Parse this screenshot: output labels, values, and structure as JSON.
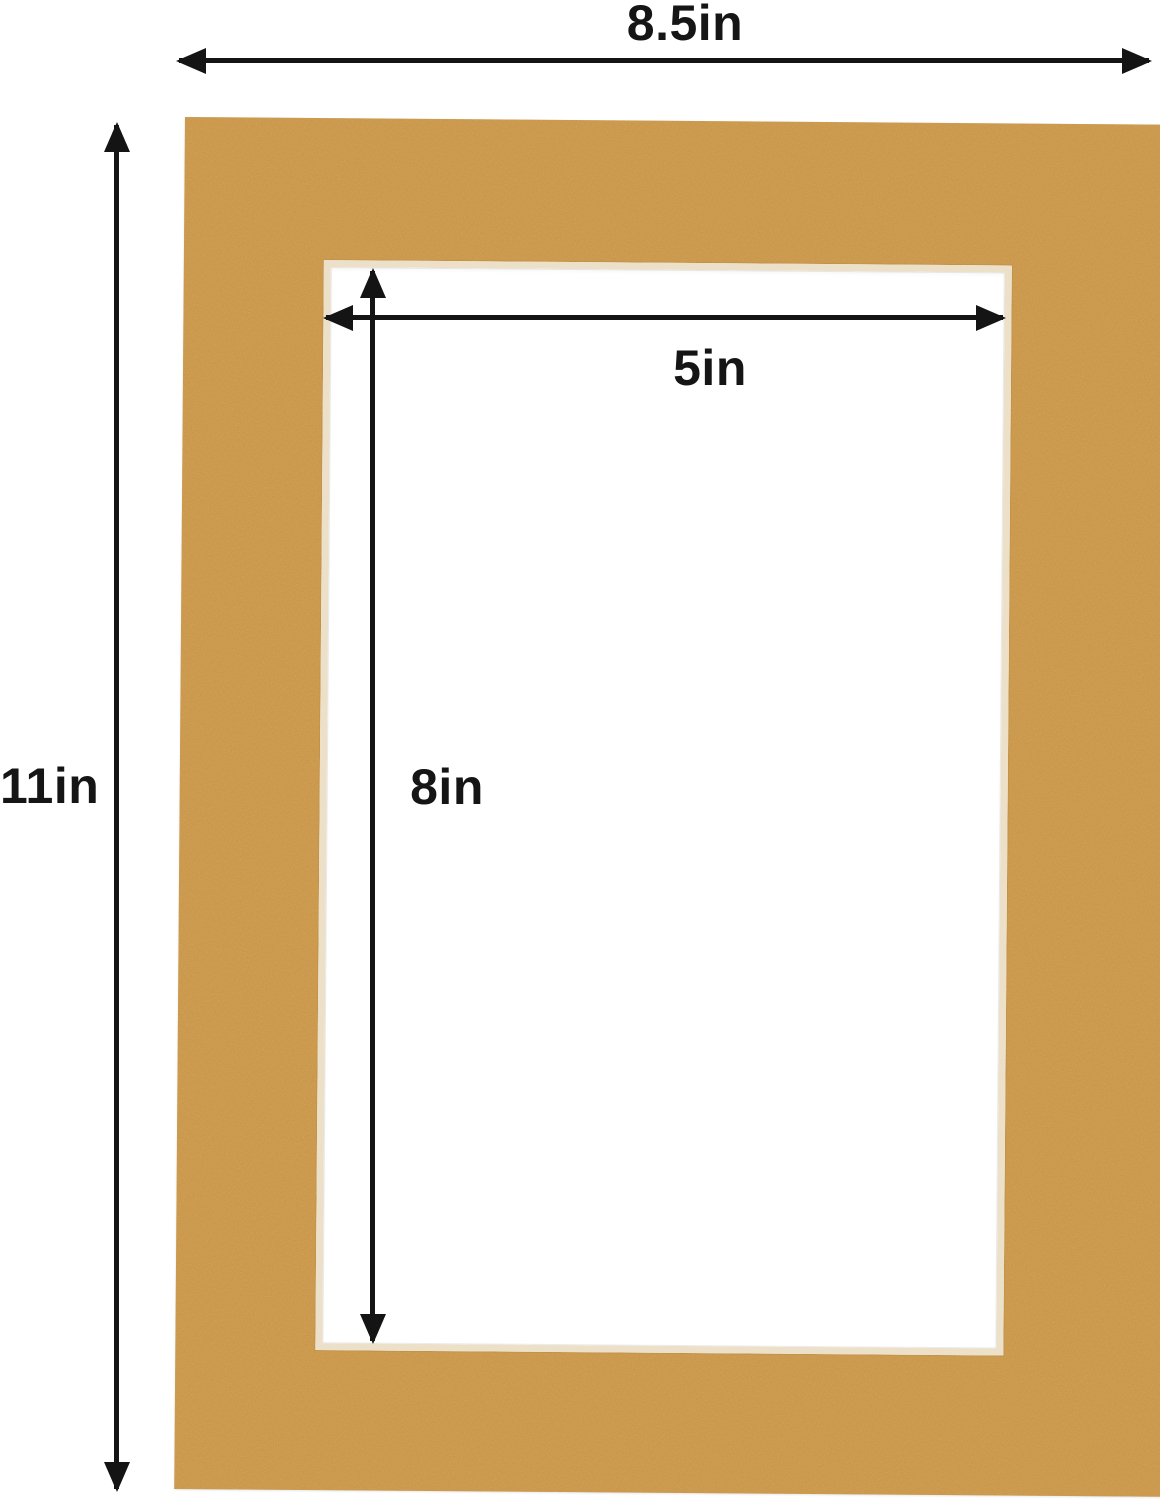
{
  "figure": {
    "type": "product-dimension-diagram",
    "subject": "picture frame mat board with rectangular opening",
    "colors": {
      "background": "#FFFFFF",
      "mat": "#C89446",
      "bevel": "#ECE0C8",
      "arrow": "#141414"
    },
    "dimensions": {
      "overall_width": {
        "label": "8.5in"
      },
      "overall_height": {
        "label": "11in"
      },
      "opening_width": {
        "label": "5in"
      },
      "opening_height": {
        "label": "8in"
      }
    }
  }
}
